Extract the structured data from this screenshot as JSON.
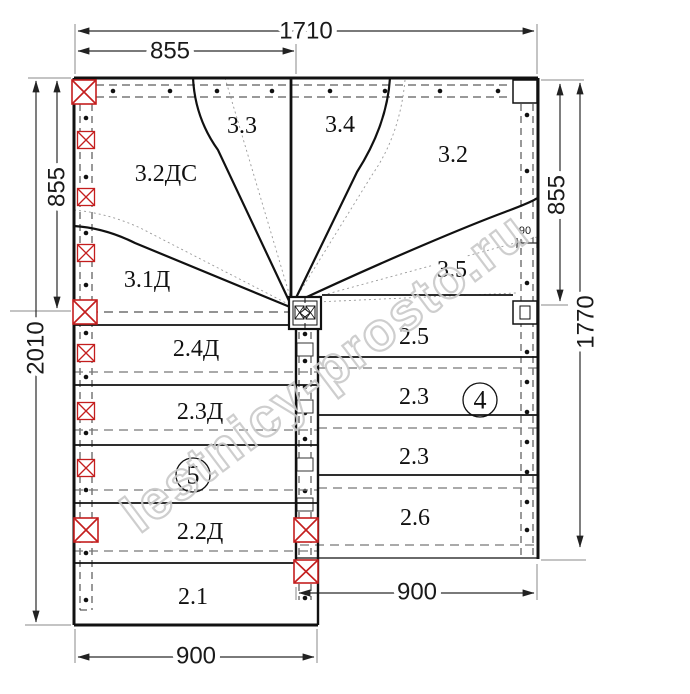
{
  "colors": {
    "line": "#111111",
    "red_post": "#c41e1e",
    "dashed_gray": "#777777",
    "watermark_gray": "#c9c9c9"
  },
  "dimensions": {
    "top_total": "1710",
    "top_left_half": "855",
    "left_upper": "855",
    "left_total": "2010",
    "right_upper": "855",
    "right_total": "1770",
    "bottom_left": "900",
    "bottom_right": "900",
    "stringer_width": "90"
  },
  "steps": {
    "winder": {
      "s33": "3.3",
      "s34": "3.4",
      "s32ds": "3.2ДС",
      "s32": "3.2",
      "s31d": "3.1Д",
      "s35": "3.5"
    },
    "left_flight": {
      "s24d": "2.4Д",
      "s23d": "2.3Д",
      "s22d": "2.2Д",
      "s21": "2.1"
    },
    "right_flight": {
      "s25": "2.5",
      "s23a": "2.3",
      "s23b": "2.3",
      "s26": "2.6"
    }
  },
  "flight_numbers": {
    "left": "5",
    "right": "4"
  },
  "watermark": "lestnicy-prosto.ru"
}
